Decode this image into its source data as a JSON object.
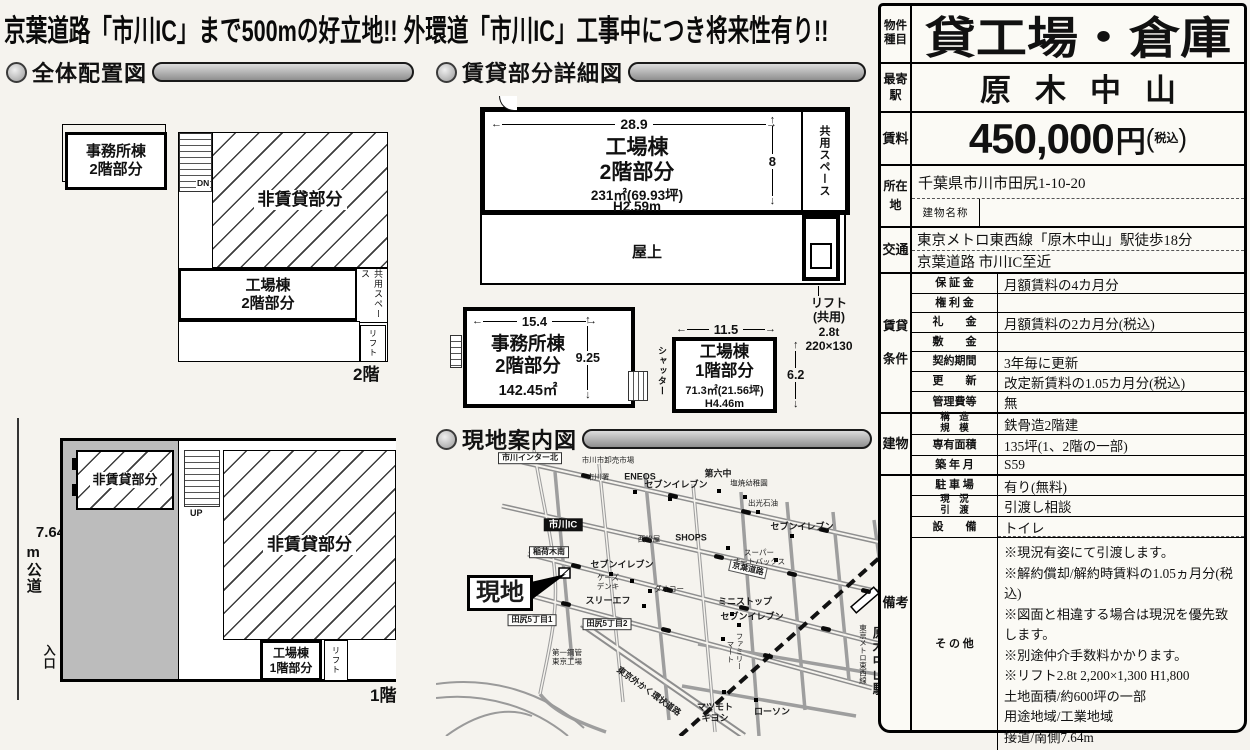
{
  "banner": "京葉道路「市川IC」まで500mの好立地!! 外環道「市川IC」工事中につき将来性有り!!",
  "sections": {
    "layout": "全体配置図",
    "detail": "賃貸部分詳細図",
    "map": "現地案内図"
  },
  "site_plan": {
    "floor2": {
      "office": "事務所棟\n2階部分",
      "stairs": "DN",
      "nonrental": "非賃貸部分",
      "factory": "工場棟\n2階部分",
      "common": "共用スペース",
      "lift": "リフト",
      "tag": "2階"
    },
    "floor1": {
      "road_num": "7.64",
      "road_text": "m公道",
      "entrance": "入口",
      "nonrental_small": "非賃貸部分",
      "stairs": "UP",
      "nonrental": "非賃貸部分",
      "factory": "工場棟\n1階部分",
      "lift": "リフト",
      "tag": "1階"
    }
  },
  "detail": {
    "factory2f": {
      "name": "工場棟\n2階部分",
      "area": "231㎡(69.93坪)",
      "height": "H2.59m",
      "w": "28.9",
      "h": "8",
      "common": "共用スペース",
      "roof": "屋上"
    },
    "lift_note": "リフト\n(共用)\n2.8t\n220×130",
    "office2f": {
      "name": "事務所棟\n2階部分",
      "area": "142.45㎡",
      "w": "15.4",
      "h": "9.25"
    },
    "factory1f": {
      "name": "工場棟\n1階部分",
      "area": "71.3㎡(21.56坪)",
      "height": "H4.46m",
      "w": "11.5",
      "h": "6.2",
      "shutter": "シャッター"
    }
  },
  "map": {
    "labels": [
      {
        "text": "市川インター北"
      },
      {
        "text": "市川市卸売市場"
      },
      {
        "text": "市川署"
      },
      {
        "text": "ENEOS"
      },
      {
        "text": "セブンイレブン"
      },
      {
        "text": "第六中"
      },
      {
        "text": "塩焼幼稚園"
      },
      {
        "text": "出光石油"
      },
      {
        "text": "セブンイレブン"
      },
      {
        "text": "SHOPS"
      },
      {
        "text": "西松屋"
      },
      {
        "text": "スーパー\nオートバックス"
      },
      {
        "text": "京葉道路"
      },
      {
        "text": "市川IC"
      },
      {
        "text": "稲荷木南"
      },
      {
        "text": "セブンイレブン"
      },
      {
        "text": "ケーズ\nデンキ"
      },
      {
        "text": "ダオコー"
      },
      {
        "text": "スリーエフ"
      },
      {
        "text": "現地"
      },
      {
        "text": "田尻5丁目1"
      },
      {
        "text": "田尻5丁目2"
      },
      {
        "text": "第一鋼管\n東京工場"
      },
      {
        "text": "東京外かく環状道路"
      },
      {
        "text": "ミニストップ"
      },
      {
        "text": "セブンイレブン"
      },
      {
        "text": "ファミリー\nマート"
      },
      {
        "text": "マツモト\nキヨシ"
      },
      {
        "text": "ローソン"
      },
      {
        "text": "原木中山駅"
      },
      {
        "text": "東京メトロ東西線"
      }
    ]
  },
  "sheet": {
    "groups": {
      "type": "物件種目",
      "station": "最寄駅",
      "rent": "賃料",
      "address": "所在地",
      "access": "交通",
      "terms": "賃貸条件",
      "building": "建物",
      "notes": "備考"
    },
    "type": "貸工場・倉庫",
    "station": "原木中山",
    "rent": {
      "amount": "450,000",
      "unit": "円",
      "paren_open": "(",
      "tax": "税込",
      "paren_close": ")"
    },
    "address": "千葉県市川市田尻1-10-20",
    "building_name_label": "建物名称",
    "building_name": "",
    "access1": "東京メトロ東西線「原木中山」駅徒歩18分",
    "access2": "京葉道路 市川IC至近",
    "terms": [
      {
        "label": "保 証 金",
        "value": "月額賃料の4カ月分"
      },
      {
        "label": "権 利 金",
        "value": ""
      },
      {
        "label": "礼　　金",
        "value": "月額賃料の2カ月分(税込)"
      },
      {
        "label": "敷　　金",
        "value": ""
      },
      {
        "label": "契約期間",
        "value": "3年毎に更新"
      },
      {
        "label": "更　　新",
        "value": "改定新賃料の1.05カ月分(税込)"
      },
      {
        "label": "管理費等",
        "value": "無"
      }
    ],
    "building": [
      {
        "label": "構　造\n規　模",
        "value": "鉄骨造2階建"
      },
      {
        "label": "専有面積",
        "value": "135坪(1、2階の一部)"
      },
      {
        "label": "築 年 月",
        "value": "S59"
      }
    ],
    "notes": [
      {
        "label": "駐 車 場",
        "value": "有り(無料)"
      },
      {
        "label": "現　況\n引　渡",
        "value": "引渡し相談"
      },
      {
        "label": "設　　備",
        "value": "トイレ"
      }
    ],
    "other_label": "そ の 他",
    "other_lines": [
      "※現況有姿にて引渡します。",
      "※解約償却/解約時賃料の1.05ヵ月分(税込)",
      "※図面と相違する場合は現況を優先致します。",
      "※別途仲介手数料かかります。",
      "※リフト2.8t 2,200×1,300 H1,800",
      "土地面積/約600坪の一部",
      "用途地域/工業地域",
      "接道/南側7.64m"
    ]
  }
}
